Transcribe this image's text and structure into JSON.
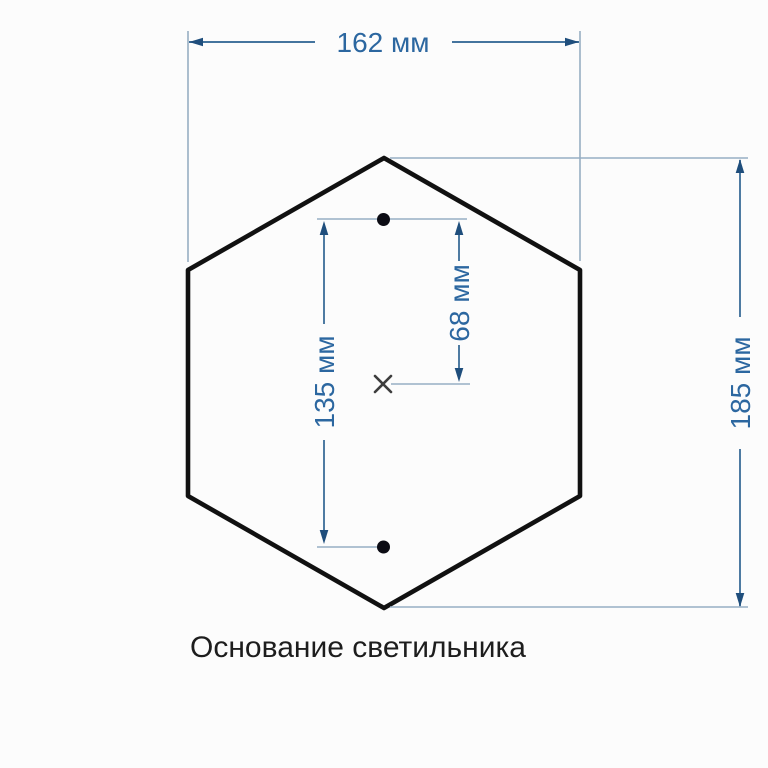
{
  "labels": {
    "width": "162 мм",
    "height": "185 мм",
    "hole_spacing": "135 мм",
    "center_to_hole": "68 мм"
  },
  "caption": "Основание светильника",
  "icons": {
    "center_mark": "x-cross-center-mark",
    "mounting_holes": "filled-circle"
  },
  "colors": {
    "background": "#fcfcfc",
    "outline": "#111111",
    "dimension_line": "#44749e",
    "extension_line": "#97aec3",
    "arrow": "#1f4e7c",
    "dimension_text": "#2c67a0",
    "hole": "#0c0c14",
    "center_mark": "#3d3d3d",
    "caption_text": "#1d1d1d"
  }
}
